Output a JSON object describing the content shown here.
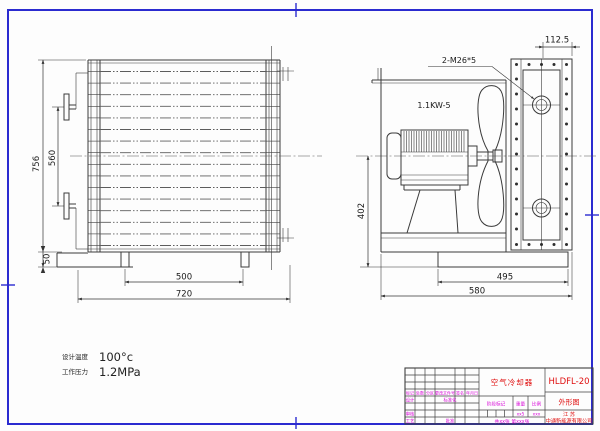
{
  "front_view": {
    "dim_overall_height": "756",
    "dim_port_distance": "560",
    "dim_base_height": "50",
    "dim_feet_span": "500",
    "dim_overall_width": "720"
  },
  "side_view": {
    "dim_depth": "112.5",
    "port_label": "2-M26*5",
    "motor_label": "1.1KW-5",
    "dim_center_height": "402",
    "dim_base_width": "495",
    "dim_overall_width": "580"
  },
  "specs": {
    "design_temp_label": "设计温度",
    "design_temp_value": "100°c",
    "working_pressure_label": "工作压力",
    "working_pressure_value": "1.2MPa"
  },
  "title_block": {
    "part_name": "空气冷却器",
    "drawing_no": "HLDFL-20",
    "view_name": "外形图",
    "company_region": "江 苏",
    "company_name": "中通新能源有限公司",
    "rev_headers": [
      "标记",
      "处数",
      "分区",
      "更改文件号",
      "签名",
      "年月日"
    ],
    "sig_design": "设计",
    "sig_standardization": "标准化",
    "sig_check": "审核",
    "sig_process": "工艺",
    "sig_approve": "批准",
    "stage_mark_label": "阶段标记",
    "weight_label": "重量",
    "scale_label": "比例",
    "weight_value": "xx5",
    "scale_value": "xxx",
    "sheet_count": "共xx张 第xxx张"
  }
}
